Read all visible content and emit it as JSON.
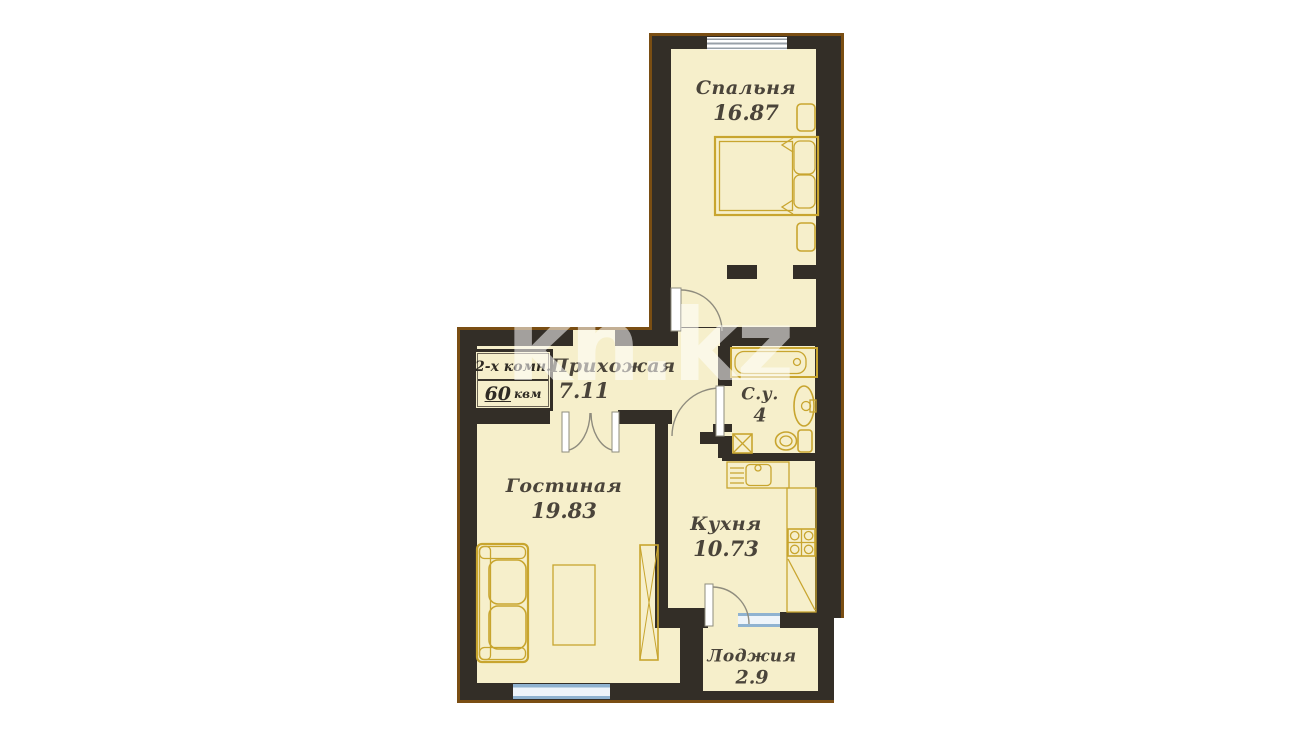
{
  "title": "2-room apartment floor plan",
  "badge": {
    "type_label": "2-х комн.",
    "area_value": "60",
    "area_unit": "квм"
  },
  "watermark": {
    "text": "kn.kz"
  },
  "rooms": {
    "bedroom": {
      "name": "Спальня",
      "area": "16.87"
    },
    "hallway": {
      "name": "Прихожая",
      "area": "7.11"
    },
    "bathroom": {
      "name": "С.у.",
      "area": "4"
    },
    "living": {
      "name": "Гостиная",
      "area": "19.83"
    },
    "kitchen": {
      "name": "Кухня",
      "area": "10.73"
    },
    "loggia": {
      "name": "Лоджия",
      "area": "2.9"
    }
  },
  "colors": {
    "wall": "#332e27",
    "room_fill": "#f6efcb",
    "furniture": "#c8a52f",
    "window_blue": "#8fb2d0",
    "brown_edge": "#7a4e13",
    "label_text": "#4a443a"
  }
}
